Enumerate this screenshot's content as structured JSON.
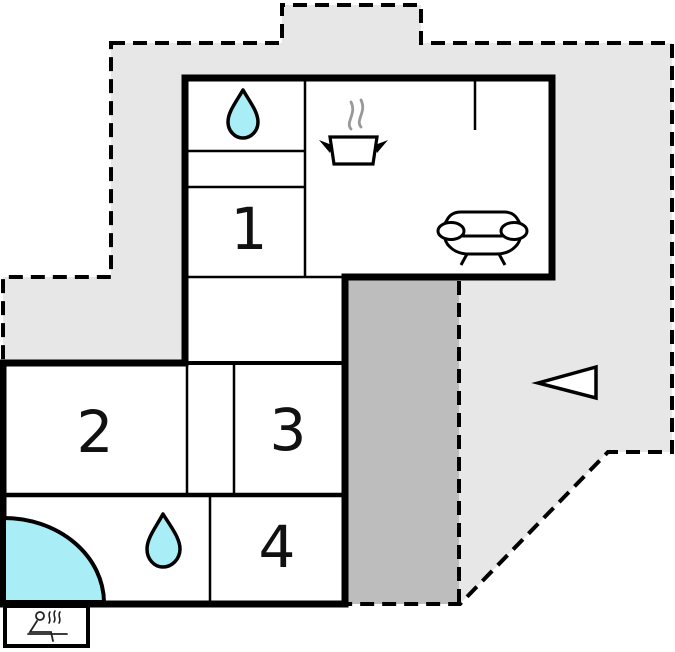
{
  "plan": {
    "type": "floor-plan",
    "rooms": [
      {
        "name": "room-1",
        "label": "1"
      },
      {
        "name": "room-2",
        "label": "2"
      },
      {
        "name": "room-3",
        "label": "3"
      },
      {
        "name": "room-4",
        "label": "4"
      }
    ],
    "icons": [
      "water-drop-icon",
      "cooking-pot-icon",
      "steam-icon",
      "sofa-icon",
      "corner-bathtub-icon",
      "water-drop-icon",
      "sauna-icon",
      "entrance-arrow-icon"
    ],
    "colors": {
      "plot_fill": "#e7e7e7",
      "terrace_fill": "#bdbdbd",
      "wall": "#000000",
      "water_fill": "#a9edf6",
      "steam_gray": "#999999",
      "room_fill": "#ffffff"
    }
  }
}
